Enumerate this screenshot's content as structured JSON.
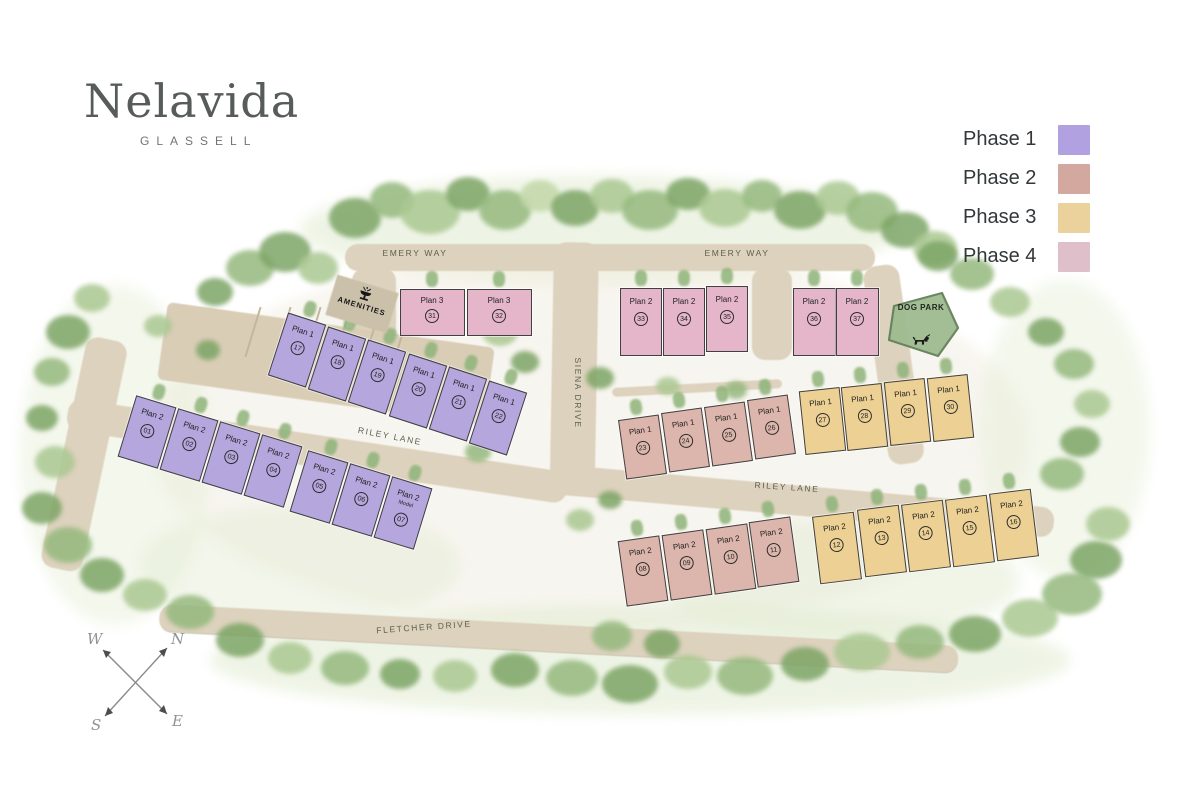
{
  "logo": {
    "name": "Nelavida",
    "subtitle": "GLASSELL"
  },
  "legend": {
    "items": [
      {
        "label": "Phase 1",
        "color": "#b2a1e0"
      },
      {
        "label": "Phase 2",
        "color": "#d3a89e"
      },
      {
        "label": "Phase 3",
        "color": "#ebd19c"
      },
      {
        "label": "Phase 4",
        "color": "#dfbfca"
      }
    ]
  },
  "map": {
    "phase_colors": {
      "1": "#b5a6dd",
      "2": "#dcb6ac",
      "3": "#ecd094",
      "4": "#e5b6ca"
    },
    "streets": [
      {
        "id": "emery-way-left",
        "label": "EMERY WAY"
      },
      {
        "id": "emery-way-right",
        "label": "EMERY WAY"
      },
      {
        "id": "siena-drive",
        "label": "SIENA DRIVE"
      },
      {
        "id": "riley-lane-left",
        "label": "RILEY LANE"
      },
      {
        "id": "riley-lane-right",
        "label": "RILEY LANE"
      },
      {
        "id": "fletcher-drive",
        "label": "FLETCHER DRIVE"
      }
    ],
    "amenities": {
      "label": "AMENITIES"
    },
    "dog_park": {
      "label": "DOG PARK"
    },
    "compass": {
      "n": "N",
      "s": "S",
      "e": "E",
      "w": "W"
    },
    "lots": [
      {
        "unit": "01",
        "plan": "Plan 2",
        "phase": "1"
      },
      {
        "unit": "02",
        "plan": "Plan 2",
        "phase": "1"
      },
      {
        "unit": "03",
        "plan": "Plan 2",
        "phase": "1"
      },
      {
        "unit": "04",
        "plan": "Plan 2",
        "phase": "1"
      },
      {
        "unit": "05",
        "plan": "Plan 2",
        "phase": "1"
      },
      {
        "unit": "06",
        "plan": "Plan 2",
        "phase": "1"
      },
      {
        "unit": "07",
        "plan": "Plan 2",
        "phase": "1",
        "note": "Model"
      },
      {
        "unit": "08",
        "plan": "Plan 2",
        "phase": "2"
      },
      {
        "unit": "09",
        "plan": "Plan 2",
        "phase": "2"
      },
      {
        "unit": "10",
        "plan": "Plan 2",
        "phase": "2"
      },
      {
        "unit": "11",
        "plan": "Plan 2",
        "phase": "2"
      },
      {
        "unit": "12",
        "plan": "Plan 2",
        "phase": "3"
      },
      {
        "unit": "13",
        "plan": "Plan 2",
        "phase": "3"
      },
      {
        "unit": "14",
        "plan": "Plan 2",
        "phase": "3"
      },
      {
        "unit": "15",
        "plan": "Plan 2",
        "phase": "3"
      },
      {
        "unit": "16",
        "plan": "Plan 2",
        "phase": "3"
      },
      {
        "unit": "17",
        "plan": "Plan 1",
        "phase": "1"
      },
      {
        "unit": "18",
        "plan": "Plan 1",
        "phase": "1"
      },
      {
        "unit": "19",
        "plan": "Plan 1",
        "phase": "1"
      },
      {
        "unit": "20",
        "plan": "Plan 1",
        "phase": "1"
      },
      {
        "unit": "21",
        "plan": "Plan 1",
        "phase": "1"
      },
      {
        "unit": "22",
        "plan": "Plan 1",
        "phase": "1"
      },
      {
        "unit": "23",
        "plan": "Plan 1",
        "phase": "2"
      },
      {
        "unit": "24",
        "plan": "Plan 1",
        "phase": "2"
      },
      {
        "unit": "25",
        "plan": "Plan 1",
        "phase": "2"
      },
      {
        "unit": "26",
        "plan": "Plan 1",
        "phase": "2"
      },
      {
        "unit": "27",
        "plan": "Plan 1",
        "phase": "3"
      },
      {
        "unit": "28",
        "plan": "Plan 1",
        "phase": "3"
      },
      {
        "unit": "29",
        "plan": "Plan 1",
        "phase": "3"
      },
      {
        "unit": "30",
        "plan": "Plan 1",
        "phase": "3"
      },
      {
        "unit": "31",
        "plan": "Plan 3",
        "phase": "4"
      },
      {
        "unit": "32",
        "plan": "Plan 3",
        "phase": "4"
      },
      {
        "unit": "33",
        "plan": "Plan 2",
        "phase": "4"
      },
      {
        "unit": "34",
        "plan": "Plan 2",
        "phase": "4"
      },
      {
        "unit": "35",
        "plan": "Plan 2",
        "phase": "4"
      },
      {
        "unit": "36",
        "plan": "Plan 2",
        "phase": "4"
      },
      {
        "unit": "37",
        "plan": "Plan 2",
        "phase": "4"
      }
    ]
  }
}
